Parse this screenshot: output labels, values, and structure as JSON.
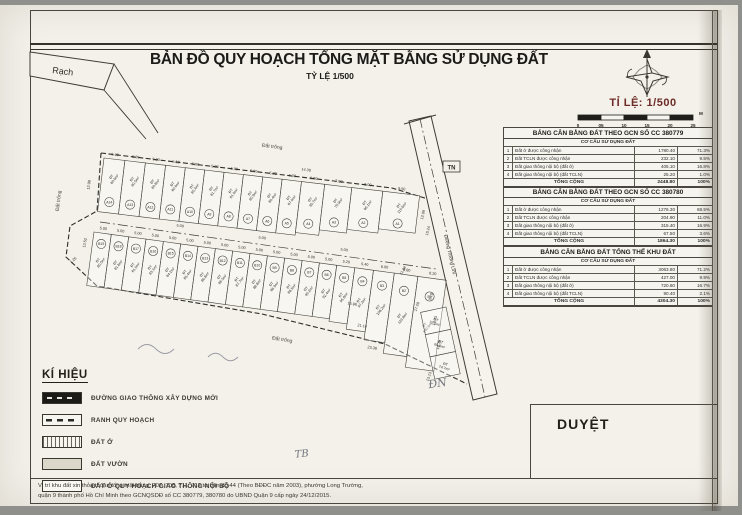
{
  "title": {
    "line1": "BẢN ĐỒ QUY HOẠCH TỔNG MẶT BẰNG SỬ DỤNG ĐẤT",
    "line2": "TỶ LỆ 1/500"
  },
  "north": {
    "scale_label": "TỈ LỆ: 1/500",
    "ticks": [
      "0",
      "05",
      "10",
      "15",
      "20",
      "25"
    ],
    "unit": "M"
  },
  "rach_label": "Rạch",
  "map": {
    "road_name": "Đường Trường Lưu",
    "corners": {
      "tn": "TN",
      "dn": "ĐN",
      "tb": "TB"
    },
    "vacant_labels": [
      {
        "t": "Đất trống",
        "x": 272,
        "y": 143,
        "r": 7
      },
      {
        "t": "Đất trống",
        "x": 60,
        "y": 196,
        "r": -83
      },
      {
        "t": "Đất trống",
        "x": 282,
        "y": 336,
        "r": 9
      }
    ],
    "edge_dims": [
      {
        "t": "14.39",
        "x": 306,
        "y": 166,
        "r": 7
      },
      {
        "t": "12.98",
        "x": 90,
        "y": 180,
        "r": -83
      },
      {
        "t": "13.52",
        "x": 86,
        "y": 238,
        "r": -80
      },
      {
        "t": "1.26",
        "x": 74,
        "y": 256,
        "r": -40
      },
      {
        "t": "12.99",
        "x": 424,
        "y": 210,
        "r": -76
      },
      {
        "t": "10.24",
        "x": 429,
        "y": 226,
        "r": -76
      },
      {
        "t": "11.08",
        "x": 404,
        "y": 266,
        "r": -60
      },
      {
        "t": "17.08",
        "x": 418,
        "y": 302,
        "r": -72
      },
      {
        "t": "15.98",
        "x": 352,
        "y": 300,
        "r": 9
      },
      {
        "t": "21.14",
        "x": 362,
        "y": 322,
        "r": 9
      },
      {
        "t": "23.38",
        "x": 372,
        "y": 344,
        "r": 9
      },
      {
        "t": "5.00",
        "x": 180,
        "y": 222,
        "r": 7
      },
      {
        "t": "5.00",
        "x": 262,
        "y": 234,
        "r": 7
      },
      {
        "t": "5.00",
        "x": 344,
        "y": 246,
        "r": 7
      },
      {
        "t": "8.18",
        "x": 432,
        "y": 292,
        "r": -75
      },
      {
        "t": "10.73",
        "x": 436,
        "y": 316,
        "r": -75
      },
      {
        "t": "10.79",
        "x": 440,
        "y": 340,
        "r": -75
      },
      {
        "t": "13.13",
        "x": 430,
        "y": 372,
        "r": -70
      }
    ],
    "rows": [
      {
        "name": "row-A",
        "start": [
          104,
          153
        ],
        "angle": 6.8,
        "scale": 3.9,
        "depth": 54,
        "idPos": 0.8,
        "areaPos": 0.34,
        "lots": [
          {
            "id": "A14",
            "w": 5.4,
            "area": "80.9m²"
          },
          {
            "id": "A13",
            "w": 5.3,
            "area": "80.5m²"
          },
          {
            "id": "A12",
            "w": 5.2,
            "area": "80.8m²"
          },
          {
            "id": "A11",
            "w": 5.1,
            "area": "80.6m²"
          },
          {
            "id": "A10",
            "w": 5.0,
            "area": "80.4m²"
          },
          {
            "id": "A9",
            "w": 5.0,
            "area": "81.7m²"
          },
          {
            "id": "A8",
            "w": 5.0,
            "area": "81.0m²"
          },
          {
            "id": "A7",
            "w": 5.0,
            "area": "80.9m²"
          },
          {
            "id": "A6",
            "w": 5.0,
            "area": "80.4m²"
          },
          {
            "id": "A5",
            "w": 5.0,
            "area": "87.0m²"
          },
          {
            "id": "A4",
            "w": 6.0,
            "area": "95.7m²",
            "df": 0.95
          },
          {
            "id": "A3",
            "w": 7.0,
            "area": "75.9m²",
            "df": 0.85
          },
          {
            "id": "A2",
            "w": 8.0,
            "area": "96.1m²",
            "df": 0.78
          },
          {
            "id": "A1",
            "w": 9.5,
            "area": "115.9m²",
            "df": 0.7
          }
        ]
      },
      {
        "name": "row-B",
        "start": [
          94,
          227
        ],
        "angle": 7.8,
        "scale": 3.5,
        "depth": 54,
        "idPos": 0.2,
        "areaPos": 0.52,
        "lots": [
          {
            "id": "B19",
            "w": 5.0,
            "area": "80.0m²"
          },
          {
            "id": "B18",
            "w": 5.0,
            "area": "81.8m²"
          },
          {
            "id": "B17",
            "w": 5.0,
            "area": "81.5m²"
          },
          {
            "id": "B16",
            "w": 5.0,
            "area": "83.1m²"
          },
          {
            "id": "B15",
            "w": 5.0,
            "area": "84.2m²"
          },
          {
            "id": "B14",
            "w": 5.0,
            "area": "85.4m²"
          },
          {
            "id": "B13",
            "w": 5.0,
            "area": "86.8m²"
          },
          {
            "id": "B12",
            "w": 5.0,
            "area": "86.5m²"
          },
          {
            "id": "B11",
            "w": 5.0,
            "area": "87.7m²"
          },
          {
            "id": "B10",
            "w": 5.0,
            "area": "88.8m²"
          },
          {
            "id": "B9",
            "w": 5.0,
            "area": "86.9m²"
          },
          {
            "id": "B8",
            "w": 5.0,
            "area": "88.5m²"
          },
          {
            "id": "B7",
            "w": 5.0,
            "area": "90.2m²"
          },
          {
            "id": "B6",
            "w": 5.0,
            "area": "92.4m²"
          },
          {
            "id": "B5",
            "w": 5.2,
            "area": "95.8m²",
            "df": 1.05
          },
          {
            "id": "B4",
            "w": 5.4,
            "area": "97.2m²",
            "df": 1.15
          },
          {
            "id": "B3",
            "w": 6.0,
            "area": "108.2m²",
            "df": 1.3
          },
          {
            "id": "B2",
            "w": 6.8,
            "area": "123.8m²",
            "df": 1.5
          },
          {
            "id": "B1",
            "w": 8.2,
            "area": "140.6m²",
            "df": 1.7
          }
        ]
      },
      {
        "name": "row-C",
        "start": [
          446,
          302
        ],
        "angle": 78,
        "scale": 3.5,
        "depth": 26,
        "dims": false,
        "idPos": 0.5,
        "areaPos": 0.5,
        "lots": [
          {
            "id": "",
            "w": 6.5,
            "area": "77.5m²"
          },
          {
            "id": "",
            "w": 6.5,
            "area": "69.8m²"
          },
          {
            "id": "",
            "w": 6.5,
            "area": "74.7m²"
          }
        ]
      }
    ]
  },
  "tables": [
    {
      "title": "BẢNG CÂN BẰNG ĐẤT THEO GCN SỐ CC 380779",
      "subtitle": "CƠ CẤU SỬ DỤNG ĐẤT",
      "rows": [
        [
          "1",
          "Đất ở được công nhận",
          "1780.40",
          "71.3%"
        ],
        [
          "2",
          "Đất TCLN được công nhận",
          "232.10",
          "9.5%"
        ],
        [
          "3",
          "Đất giao thông nội bộ (đất ở)",
          "405.10",
          "16.8%"
        ],
        [
          "4",
          "Đất giao thông nội bộ (đất TCLN)",
          "25.20",
          "1.0%"
        ]
      ],
      "total": [
        "TỔNG CỘNG",
        "2448.80",
        "100%"
      ]
    },
    {
      "title": "BẢNG CÂN BẰNG ĐẤT THEO GCN SỐ CC 380780",
      "subtitle": "CƠ CẤU SỬ DỤNG ĐẤT",
      "rows": [
        [
          "1",
          "Đất ở được công nhận",
          "1276.30",
          "68.5%"
        ],
        [
          "2",
          "Đất TCLN được công nhận",
          "204.90",
          "11.0%"
        ],
        [
          "3",
          "Đất giao thông nội bộ (đất ở)",
          "315.40",
          "16.9%"
        ],
        [
          "4",
          "Đất giao thông nội bộ (đất TCLN)",
          "67.50",
          "3.6%"
        ]
      ],
      "total": [
        "TỔNG CỘNG",
        "1864.30",
        "100%"
      ]
    },
    {
      "title": "BẢNG CÂN BẰNG ĐẤT TỔNG THỂ KHU ĐẤT",
      "subtitle": "CƠ CẤU SỬ DỤNG ĐẤT",
      "rows": [
        [
          "1",
          "Đất ở được công nhận",
          "3063.80",
          "71.2%"
        ],
        [
          "2",
          "Đất TCLN được công nhận",
          "427.00",
          "9.9%"
        ],
        [
          "3",
          "Đất giao thông nội bộ (đất ở)",
          "720.60",
          "16.7%"
        ],
        [
          "4",
          "Đất giao thông nội bộ (đất TCLN)",
          "90.40",
          "2.1%"
        ]
      ],
      "total": [
        "TỔNG CỘNG",
        "4304.30",
        "100%"
      ]
    }
  ],
  "legend": {
    "title": "KÍ HIỆU",
    "items": [
      {
        "type": "road-new",
        "label": "ĐƯỜNG GIAO THÔNG XÂY DỰNG MỚI"
      },
      {
        "type": "boundary",
        "label": "RANH QUY HOẠCH"
      },
      {
        "type": "dat-o",
        "label": "ĐẤT Ở"
      },
      {
        "type": "dat-vuon",
        "label": "ĐẤT VƯỜN"
      },
      {
        "type": "dat-o-gt",
        "label": "ĐẤT Ở QUY HOẠCH GIAO THÔNG NỘI BỘ"
      }
    ]
  },
  "approval": {
    "label": "DUYỆT"
  },
  "footnote": {
    "line1": "Vị trí khu đất xin thỏa thuận tổng mặt bằng: 707, 708, 711, 712 tờ bản đồ 44 (Theo BĐĐC năm 2003), phường Long Trường,",
    "line2": "quận 9 thành phố Hồ Chí Minh theo GCNQSDĐ số CC 380779, 380780 do UBND Quận 9 cấp ngày 24/12/2015."
  },
  "colors": {
    "scale_red": "#6e2a26",
    "ink": "#2f2f2f",
    "paper": "#f3f1ea"
  }
}
